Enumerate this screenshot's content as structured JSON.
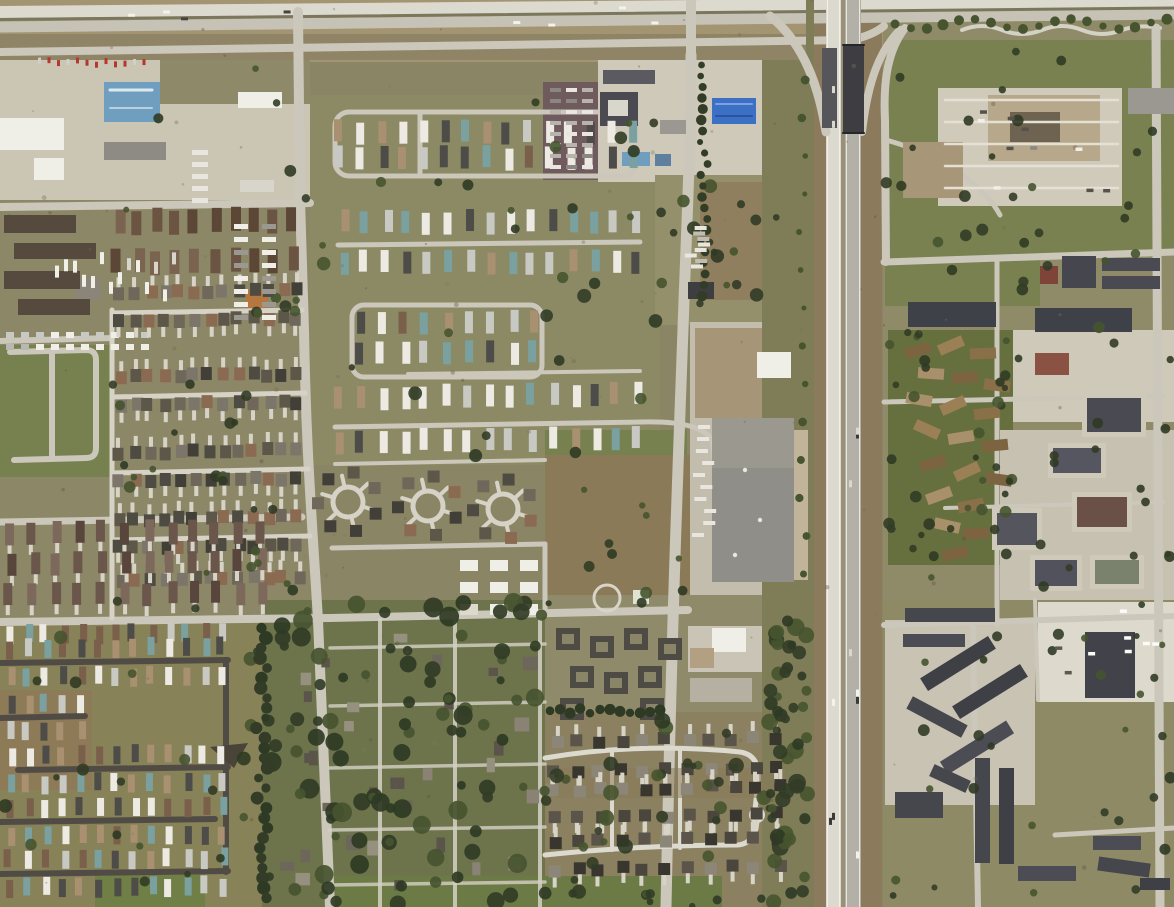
{
  "meta": {
    "image_type": "satellite-aerial-photograph",
    "description": "Overhead satellite view of a suburban area: a north-south freeway corridor with an overpass on the right third, a divided highway across the top, mobile-home parks, dense single-family residential grids, industrial lots in the northwest, commercial pads along the freeway, and apartment/condo campuses east of the freeway.",
    "visible_text_present": false,
    "visible_text": []
  },
  "palette": {
    "grass_olive": "#8a8565",
    "grass_green": "#77804f",
    "lawn_green": "#7a8150",
    "field_brown": "#8a7a58",
    "field_tan": "#a39472",
    "dirt": "#97866a",
    "concrete": "#cbc5b4",
    "road": "#cbc7ba",
    "road_bright": "#dcd9cf",
    "asphalt": "#b3b1a7",
    "street_dark": "#504c45",
    "median": "#7a775c",
    "bridge_dark": "#3d3d42",
    "tree_dark": "#323c26",
    "tree_mid": "#46542f",
    "roof_dark": "#46464d",
    "roof_gray": "#8e8b84",
    "roof_brown": "#6b5442",
    "roof_tan": "#b8a88b",
    "condo_tan": "#9b8055",
    "building_white": "#efeee7",
    "blue_roof": "#6f9ebf",
    "blue_canopy": "#3c70c4",
    "purple_lot": "#6f5a5e",
    "orange_roof": "#b5763f",
    "red_accent": "#b43830"
  },
  "scene": {
    "features": [
      "top-divided-highway",
      "north-frontage-road",
      "west-arterial-road",
      "center-arterial-road",
      "freeway-corridor-with-overpass",
      "east-frontage-road",
      "northwest-industrial-lots",
      "blue-warehouse",
      "truck-stop-blue-canopy",
      "mauve-trailer-storage-lot",
      "central-mobile-home-park",
      "southwest-mobile-home-park",
      "west-apartment-complex",
      "townhouse-rows",
      "vacant-field-loop-road",
      "duplex-rows",
      "left-residential-grid",
      "cul-de-sac-wagon-wheels",
      "big-box-retail-building",
      "school-building",
      "old-treed-neighborhood",
      "south-cul-de-sac-subdivision",
      "east-office-campus",
      "east-apartment-strips",
      "tan-condo-cluster",
      "southeast-apartment-campus",
      "greenbelt-tree-line"
    ]
  }
}
